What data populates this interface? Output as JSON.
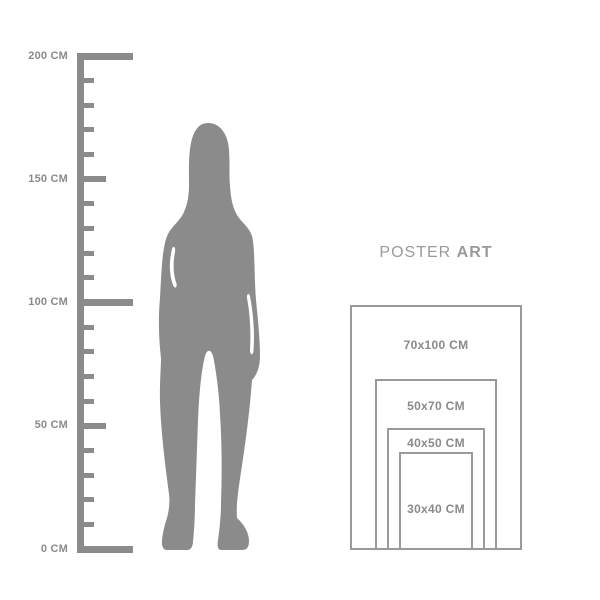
{
  "colors": {
    "background": "#ffffff",
    "figure_gray": "#8b8b8b",
    "ruler_gray": "#8b8b8b",
    "rect_line_gray": "#9a9a9a",
    "label_gray": "#8a8a8a",
    "title_gray": "#9a9a9a"
  },
  "ruler": {
    "unit": "CM",
    "min_cm": 0,
    "max_cm": 200,
    "tick_step_cm": 10,
    "medium_tick_every_cm": 50,
    "major_tick_every_cm": 100,
    "labeled_ticks": [
      {
        "value": 200,
        "label": "200 CM"
      },
      {
        "value": 150,
        "label": "150 CM"
      },
      {
        "value": 100,
        "label": "100 CM"
      },
      {
        "value": 50,
        "label": "50 CM"
      },
      {
        "value": 0,
        "label": "0 CM"
      }
    ]
  },
  "figure": {
    "name": "standing-woman-silhouette",
    "approx_height_cm": 174
  },
  "poster_guide": {
    "title_regular": "POSTER",
    "title_bold": "ART",
    "sizes": [
      {
        "label": "70x100 CM",
        "width_cm": 70,
        "height_cm": 100
      },
      {
        "label": "50x70 CM",
        "width_cm": 50,
        "height_cm": 70
      },
      {
        "label": "40x50 CM",
        "width_cm": 40,
        "height_cm": 50
      },
      {
        "label": "30x40 CM",
        "width_cm": 30,
        "height_cm": 40
      }
    ]
  },
  "scale_px_per_cm": 2.45
}
